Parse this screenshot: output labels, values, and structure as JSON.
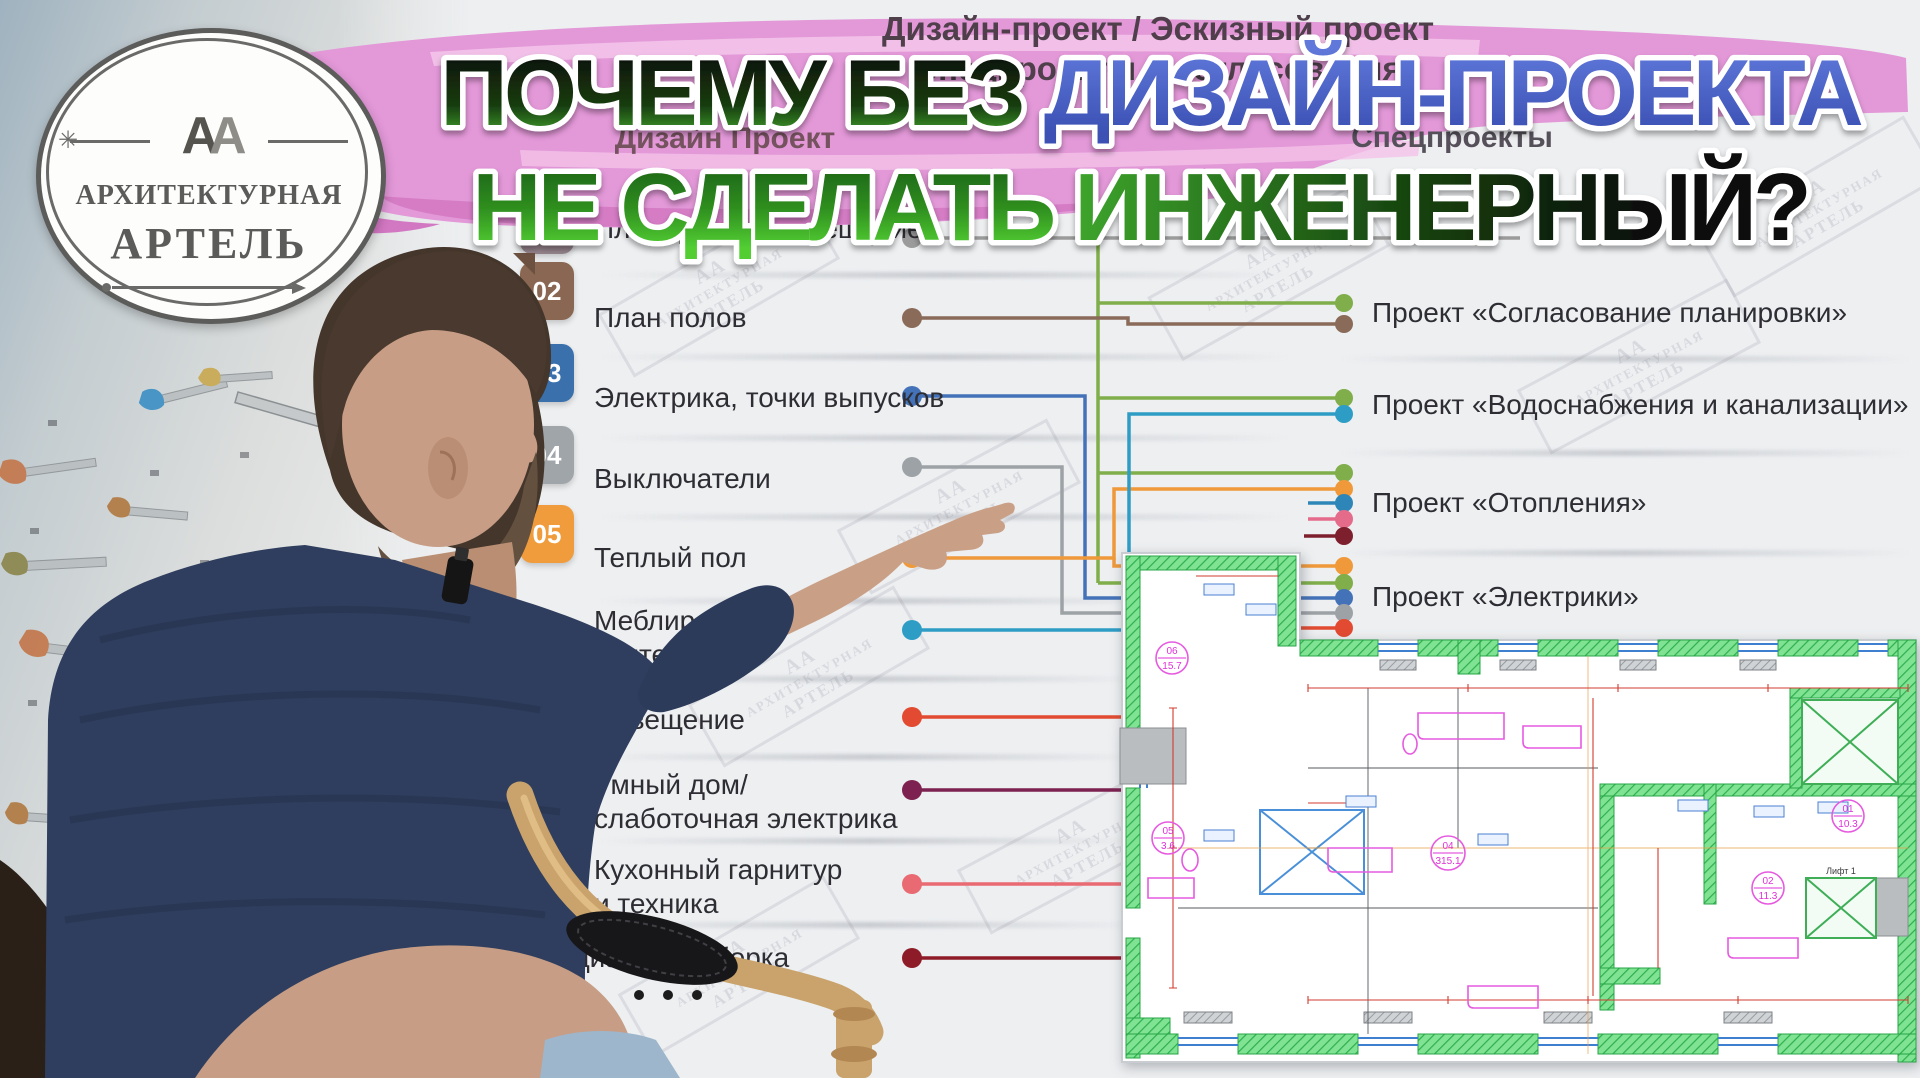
{
  "logo": {
    "monogram_a1": "А",
    "monogram_a2": "А",
    "line1": "АРХИТЕКТУРНАЯ",
    "line2": "АРТЕЛЬ"
  },
  "watermark": {
    "aa": "АА"
  },
  "title": {
    "line1_black": "ПОЧЕМУ БЕЗ",
    "line1_blue": "ДИЗАЙН-ПРОЕКТА",
    "line2_green": "НЕ СДЕЛАТЬ",
    "line2_fade": "ИНЖЕНЕРНЫЙ?"
  },
  "flow_header": {
    "line1": "Дизайн-проект / Эскизный проект",
    "line2": "Спецпроекты и согласования"
  },
  "column_headers": {
    "left": "Дизайн Проект",
    "right": "Спецпроекты"
  },
  "design_stages": [
    {
      "num": "01",
      "label": "Планировочное решение",
      "label2": ""
    },
    {
      "num": "02",
      "label": "План полов",
      "label2": ""
    },
    {
      "num": "03",
      "label": "Электрика, точки выпусков",
      "label2": ""
    },
    {
      "num": "04",
      "label": "Выключатели",
      "label2": ""
    },
    {
      "num": "05",
      "label": "Теплый пол",
      "label2": ""
    },
    {
      "num": "",
      "label": "Меблировка,",
      "label2": "сантехника"
    },
    {
      "num": "",
      "label": "Освещение",
      "label2": ""
    },
    {
      "num": "",
      "label": "Умный дом/",
      "label2": "слаботочная электрика"
    },
    {
      "num": "",
      "label": "Кухонный гарнитур",
      "label2": "и техника"
    },
    {
      "num": "",
      "label": "Радиаторы, сборка",
      "label2": ""
    }
  ],
  "spec_projects": [
    {
      "label": "Проект «Согласование планировки»"
    },
    {
      "label": "Проект «Водоснабжения и канализации»"
    },
    {
      "label": "Проект «Отопления»"
    },
    {
      "label": "Проект «Электрики»"
    }
  ],
  "floorplan": {
    "rooms": [
      {
        "num": "06",
        "area": "15.7"
      },
      {
        "num": "05",
        "area": "3.6"
      },
      {
        "num": "04",
        "area": "315.1"
      },
      {
        "num": "02",
        "area": "11.3"
      },
      {
        "num": "01",
        "area": "10.3"
      }
    ],
    "elevator": "Лифт 1"
  },
  "colors": {
    "banner_pink": "#e398d8",
    "banner_pink_light": "#f2c3e9",
    "banner_pink_deep": "#d277c2",
    "title_blue_top": "#5f78da",
    "title_blue_bottom": "#3c51b4",
    "title_green_bright": "#52ce33",
    "badge_01": "#94838b",
    "badge_02": "#8a6752",
    "badge_03": "#3a71ad",
    "badge_04": "#9fa5a9",
    "badge_05": "#f09c3c",
    "line_gray": "#9b9b9b",
    "line_brown": "#8a6a58",
    "line_green": "#7fae4a",
    "line_blue": "#4472b8",
    "line_teal": "#2e9dc6",
    "line_orange": "#f0993a",
    "line_red": "#e24b31",
    "line_dark_magenta": "#7c2150",
    "line_salmon": "#e96a72",
    "line_dark_red": "#8e1c28",
    "line_blue2": "#2e86b8",
    "line_pink2": "#e56b8a",
    "line_dark_red2": "#7e1f2d",
    "line_gray2": "#9da2a6",
    "plan_wall_green": "#7fe393",
    "plan_hatch_green": "#2fae4e",
    "plan_dim_red": "#d23b2f",
    "plan_magenta": "#e65ae0",
    "plan_blue": "#4a90d9",
    "plan_gray": "#b9bdc0"
  }
}
